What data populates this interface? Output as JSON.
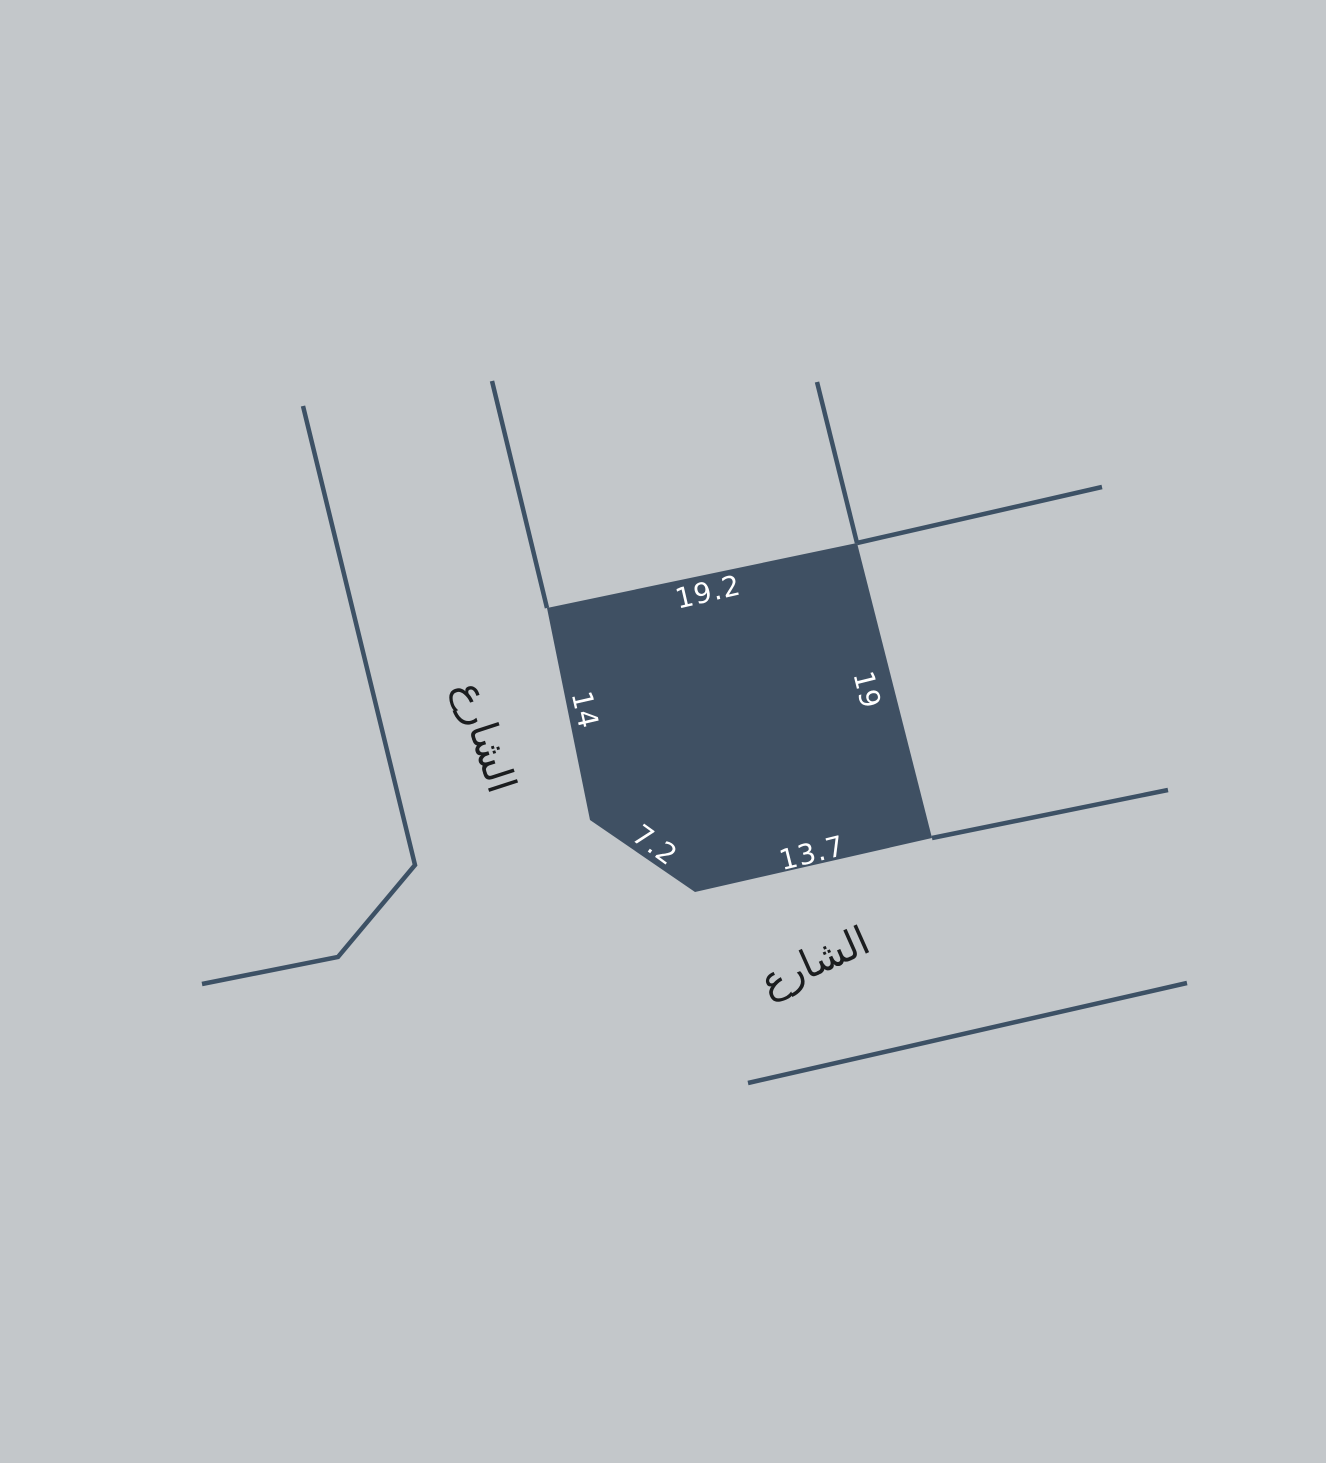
{
  "parcel": {
    "edge_labels": {
      "top": "19.2",
      "right": "19",
      "left": "14",
      "bottom_left": "7.2",
      "bottom": "13.7"
    }
  },
  "streets": {
    "left_label": "الشارع",
    "bottom_label": "الشارع"
  },
  "colors": {
    "background": "#c3c7ca",
    "parcel_fill": "#3f5063",
    "street_line": "#3d5165",
    "dimension_text": "#ffffff",
    "street_text": "#1b1d1f"
  }
}
